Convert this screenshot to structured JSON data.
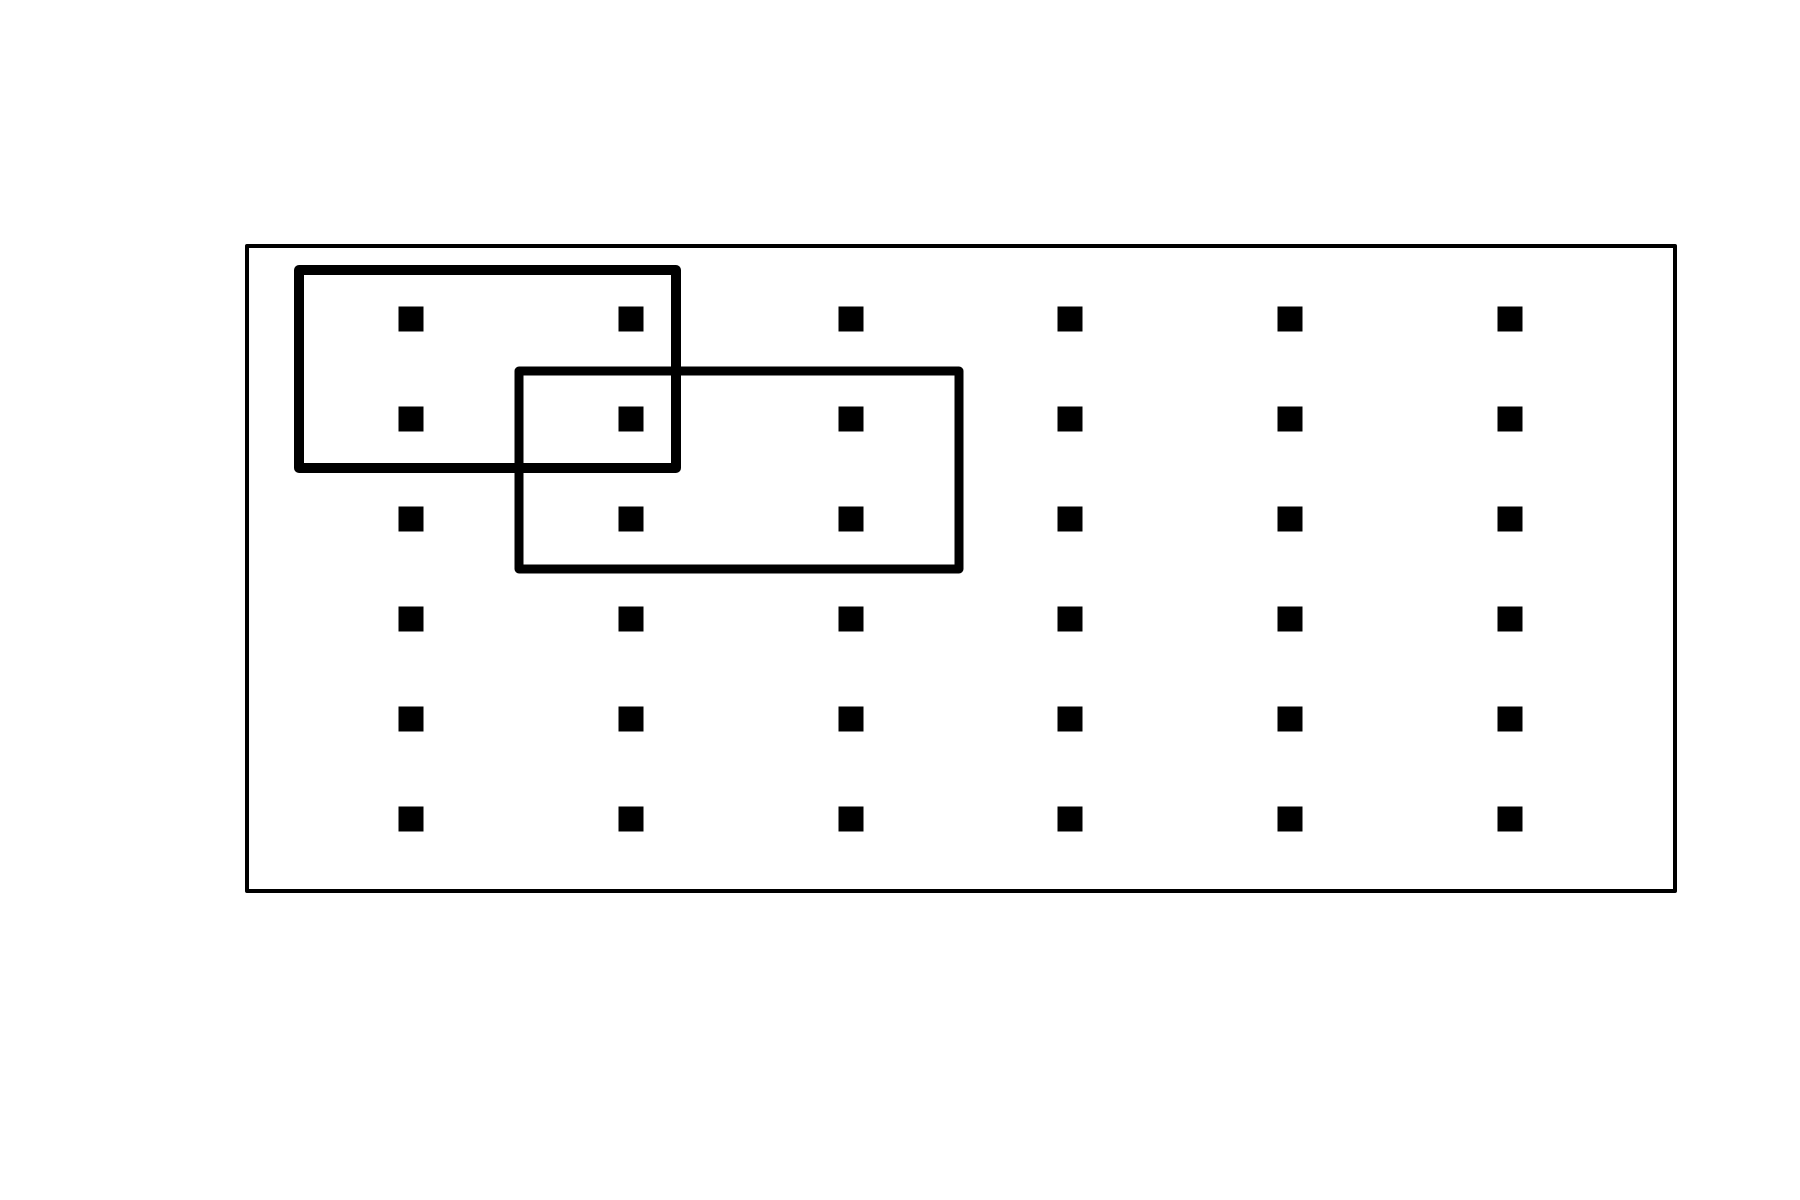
{
  "figure": {
    "description": "6x6 grid of small filled squares inside a thin rectangular frame, with two thick-outlined overlapping rectangles each enclosing four dots and sharing one dot",
    "background_color": "#ffffff",
    "stroke_color": "#000000",
    "dot_color": "#000000",
    "canvas": {
      "width": 1800,
      "height": 1200
    },
    "outer_frame": {
      "x": 247,
      "y": 246,
      "width": 1428,
      "height": 645,
      "stroke_width": 4
    },
    "dot_grid": {
      "shape": "square",
      "dot_size": 25,
      "num_columns": 6,
      "num_rows": 6,
      "total_dots": 36,
      "columns_x": [
        411,
        631,
        851,
        1070,
        1290,
        1510
      ],
      "rows_y": [
        319,
        419,
        519,
        619,
        719,
        819
      ]
    },
    "selection_boxes": [
      {
        "name": "selection-box-1",
        "x": 299,
        "y": 270,
        "width": 377,
        "height": 198,
        "stroke_width": 10,
        "dots_enclosed": 4
      },
      {
        "name": "selection-box-2",
        "x": 519,
        "y": 371,
        "width": 440,
        "height": 198,
        "stroke_width": 9,
        "dots_enclosed": 4
      }
    ],
    "dots_shared_by_both_boxes": 1
  }
}
